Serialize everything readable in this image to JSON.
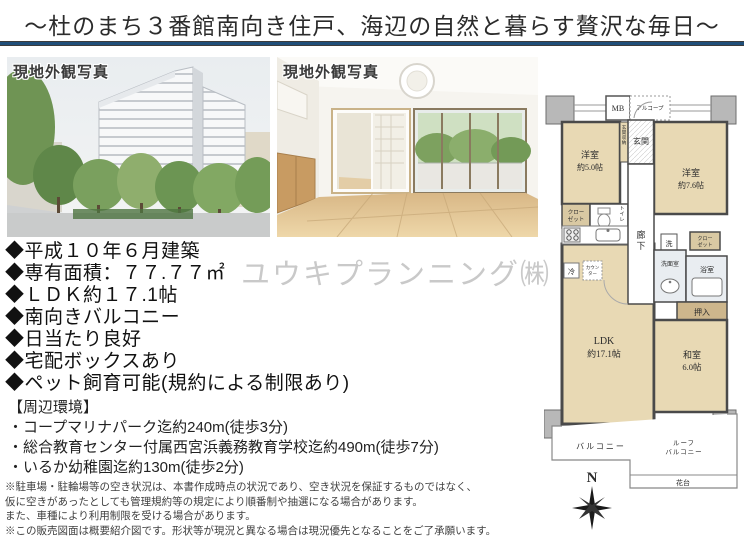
{
  "title": "〜杜のまち３番館南向き住戸、海辺の自然と暮らす贅沢な毎日〜",
  "photo1": {
    "label": "現地外観写真"
  },
  "photo2": {
    "label": "現地外観写真"
  },
  "watermark": "ユウキプランニング㈱",
  "features": [
    "◆平成１０年６月建築",
    "◆専有面積：７７.７７㎡",
    "◆ＬＤＫ約１７.1帖",
    "◆南向きバルコニー",
    "◆日当たり良好",
    "◆宅配ボックスあり",
    "◆ペット飼育可能(規約による制限あり)"
  ],
  "environment": {
    "heading": "【周辺環境】",
    "items": [
      "・コープマリナパーク迄約240m(徒歩3分)",
      "・総合教育センター付属西宮浜義務教育学校迄約490m(徒歩7分)",
      "・いるか幼稚園迄約130m(徒歩2分)"
    ]
  },
  "disclaimers": [
    "※駐車場・駐輪場等の空き状況は、本書作成時点の状況であり、空き状況を保証するものではなく、",
    "仮に空きがあったとしても管理規約等の規定により順番制や抽選になる場合があります。",
    "また、車種により利用制限を受ける場合があります。",
    "※この販売図面は概要紹介図です。形状等が現況と異なる場合は現況優先となることをご了承願います。"
  ],
  "floorplan": {
    "mb": "MB",
    "alcove": "アルコープ",
    "entrance": "玄関",
    "entrance_storage": "玄関収納",
    "west_room1_name": "洋室",
    "west_room1_size": "約5.0帖",
    "west_room2_name": "洋室",
    "west_room2_size": "約7.6帖",
    "closet1_l1": "クロー",
    "closet1_l2": "ゼット",
    "toilet": "トイレ",
    "corridor": "廊下",
    "washer": "洗",
    "closet2_l1": "クロー",
    "closet2_l2": "ゼット",
    "washroom": "洗面室",
    "bathroom": "浴室",
    "fridge": "冷",
    "counter_l1": "カウン",
    "counter_l2": "ター",
    "oshiire": "押入",
    "ldk_name": "LDK",
    "ldk_size": "約17.1帖",
    "tatami_name": "和室",
    "tatami_size": "6.0帖",
    "balcony": "バルコニー",
    "roof_balcony_l1": "ルーフ",
    "roof_balcony_l2": "バルコニー",
    "flower_stand": "花台",
    "compass_n": "N"
  },
  "colors": {
    "divider_navy": "#1f4e79",
    "room_tan": "#e8d9b4",
    "closet_tan": "#d9c9a3",
    "oshiire_tan": "#cdb68c",
    "wall_gray": "#4a4a4a",
    "block_gray": "#b8b8b8",
    "watermark_gray": "#c9c9c9"
  }
}
